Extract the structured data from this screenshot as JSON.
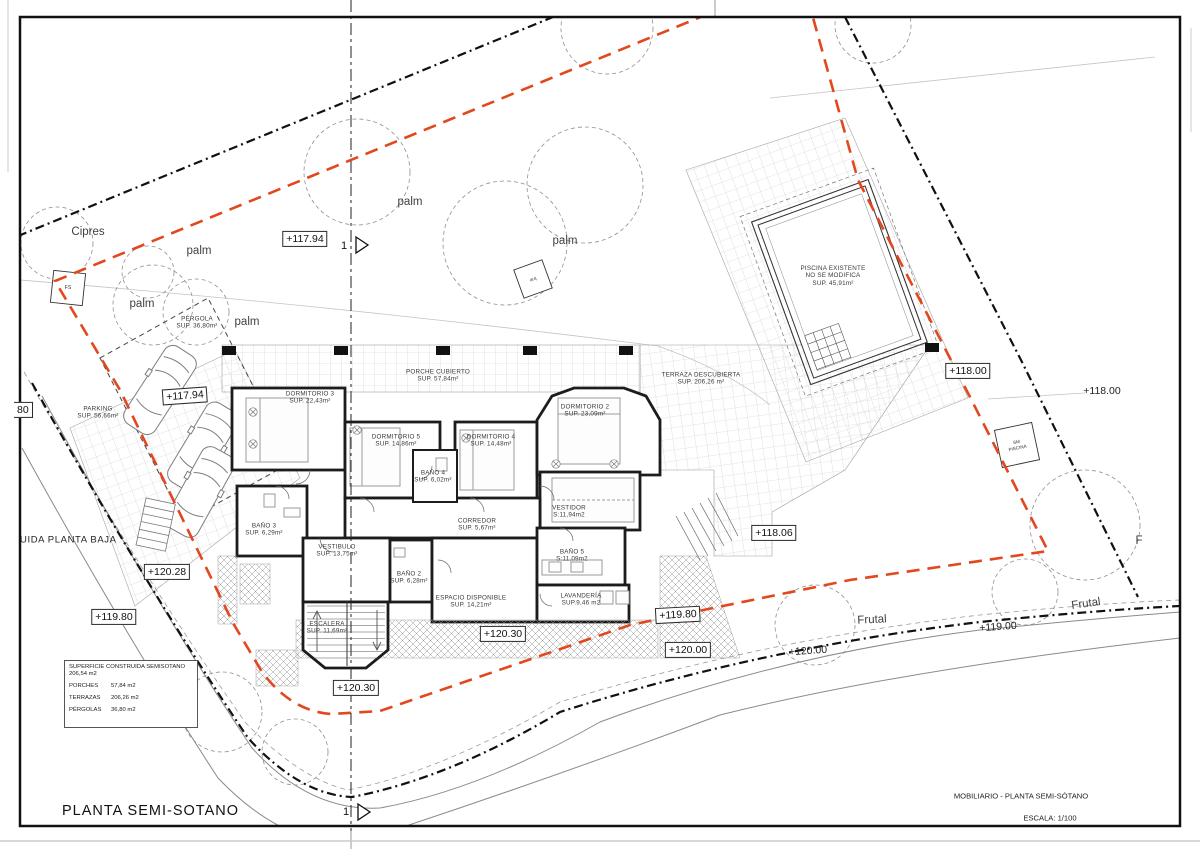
{
  "drawing": {
    "title": "PLANTA SEMI-SOTANO",
    "footer_title": "MOBILIARIO - PLANTA SEMI-SÓTANO",
    "footer_scale": "ESCALA: 1/100",
    "section_marker": "1"
  },
  "colors": {
    "setback_red": "#e2471d",
    "line_black": "#1a1a1a",
    "grid_gray": "#cccccc"
  },
  "legend": {
    "line1": "SUPERFICIE CONSTRUIDA SEMISOTANO",
    "line2": "206,54 m2",
    "porches_label": "PORCHES",
    "porches_value": "57,84 m2",
    "terrazas_label": "TERRAZAS",
    "terrazas_value": "206,26 m2",
    "pergolas_label": "PÉRGOLAS",
    "pergolas_value": "36,80 m2"
  },
  "rooms": [
    {
      "name": "PORCHE CUBIERTO",
      "area": "SUP. 57,84m²"
    },
    {
      "name": "DORMITORIO 3",
      "area": "SUP. 22,43m²"
    },
    {
      "name": "DORMITORIO 5",
      "area": "SUP. 14,86m²"
    },
    {
      "name": "DORMITORIO 4",
      "area": "SUP. 14,48m²"
    },
    {
      "name": "DORMITORIO 2",
      "area": "SUP. 23,09m²"
    },
    {
      "name": "BAÑO 4",
      "area": "SUP. 6,02m²"
    },
    {
      "name": "BAÑO 3",
      "area": "SUP. 6,29m²"
    },
    {
      "name": "VESTIDOR",
      "area": "S:11,94m2"
    },
    {
      "name": "CORREDOR",
      "area": "SUP. 5,67m²"
    },
    {
      "name": "VESTIBULO",
      "area": "SUP. 13,75m²"
    },
    {
      "name": "BAÑO 2",
      "area": "SUP. 6,28m²"
    },
    {
      "name": "BAÑO 5",
      "area": "S:11,09m2"
    },
    {
      "name": "ESPACIO DISPONIBLE",
      "area": "SUP. 14,21m²"
    },
    {
      "name": "LAVANDERÍA",
      "area": "SUP.9,46 m2"
    },
    {
      "name": "ESCALERA",
      "area": "SUP. 11,69m²"
    },
    {
      "name": "PARKING",
      "area": "SUP. 56,66m²"
    },
    {
      "name": "PÉRGOLA",
      "area": "SUP. 36,80m²"
    },
    {
      "name": "TERRAZA DESCUBIERTA",
      "area": "SUP. 206,26 m²"
    }
  ],
  "pool": {
    "line1": "PISCINA EXISTENTE",
    "line2": "NO SE MODIFICA",
    "line3": "SUP. 45,91m²"
  },
  "elevations": {
    "e117_94_a": "+117.94",
    "e117_94_b": "+117.94",
    "e118_00_box": "+118.00",
    "e118_00_plain": "+118.00",
    "e118_06": "+118.06",
    "e120_28": "+120.28",
    "e119_80_a": "+119.80",
    "e119_80_b": "+119.80",
    "e120_30_a": "+120.30",
    "e120_30_b": "+120.30",
    "e120_00_box": "+120.00",
    "e120_00_plain": "+120.00",
    "e119_00": "+119.00",
    "clipped_80": "80"
  },
  "trees": {
    "cipres": "Cipres",
    "palm": "palm",
    "frutal": "Frutal",
    "frutal_clipped": "F"
  },
  "markers": {
    "fs": "FS",
    "arq": "arq",
    "sm_line1": "SM",
    "sm_line2": "PISCINA"
  },
  "edge_text": {
    "clipped_left": "UIDA PLANTA BAJA"
  }
}
